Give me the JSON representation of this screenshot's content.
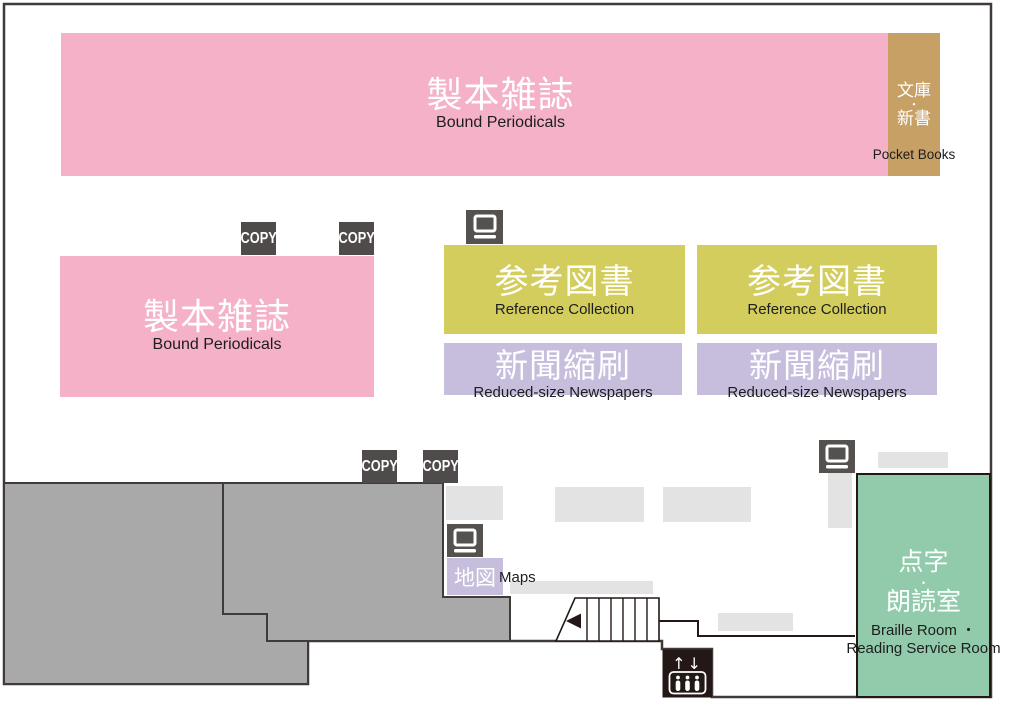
{
  "floor_map": {
    "type": "library-floor-plan",
    "colors": {
      "pink_area": "#f4b1c7",
      "tan_area": "#c7a065",
      "yellow_area": "#d3cd5e",
      "lavender_area": "#c7bddc",
      "green_area": "#92cbab",
      "closed_stack_gray": "#aaa9a9",
      "table_light_gray": "#e3e3e3",
      "outline": "#403b3a",
      "pictogram_dark": "#4f4b4b",
      "elevator_black": "#231815"
    },
    "areas": {
      "bound_periodicals_top": {
        "jp": "製本雑誌",
        "en": "Bound Periodicals"
      },
      "pocket_books": {
        "jp_line1": "文庫",
        "jp_dot": "・",
        "jp_line2": "新書",
        "en": "Pocket Books"
      },
      "bound_periodicals_left": {
        "jp": "製本雑誌",
        "en": "Bound Periodicals"
      },
      "reference_collection_left": {
        "jp": "参考図書",
        "en": "Reference Collection"
      },
      "reference_collection_right": {
        "jp": "参考図書",
        "en": "Reference Collection"
      },
      "reduced_size_newspapers_left": {
        "jp": "新聞縮刷",
        "en": "Reduced-size Newspapers"
      },
      "reduced_size_newspapers_right": {
        "jp": "新聞縮刷",
        "en": "Reduced-size Newspapers"
      },
      "maps": {
        "jp": "地図",
        "en": "Maps"
      },
      "braille_reading_room": {
        "jp_line1": "点字",
        "jp_dot": "・",
        "jp_line2": "朗読室",
        "en_line1": "Braille Room ・",
        "en_line2": "Reading Service Room"
      }
    },
    "icons": {
      "copy_label": "COPY",
      "elevator_arrows": "↑↓"
    }
  }
}
